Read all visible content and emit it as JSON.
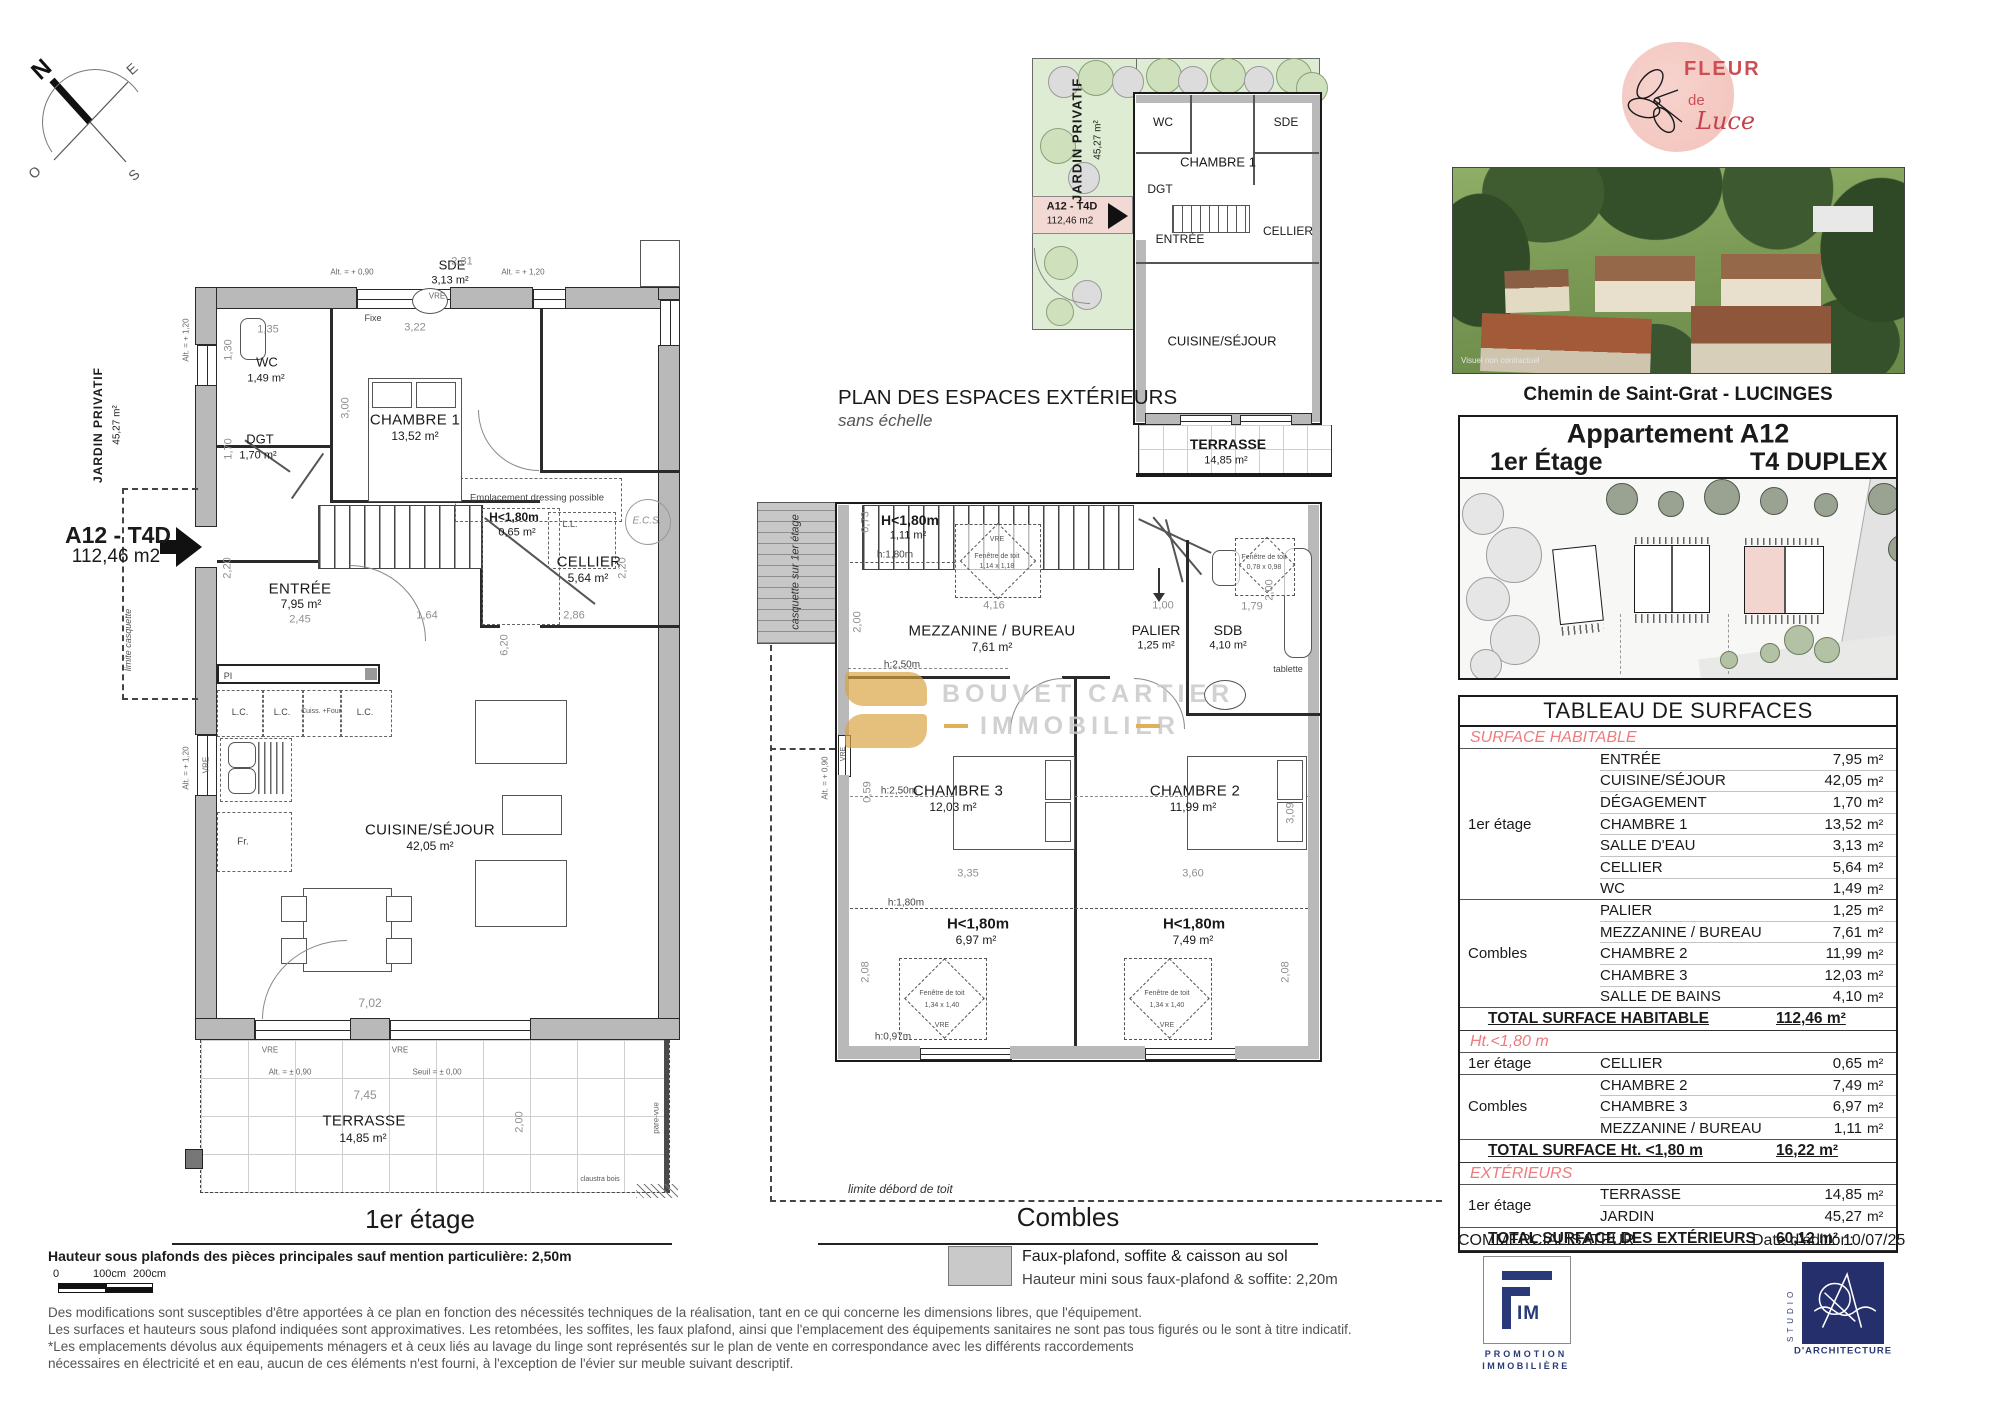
{
  "compass": {
    "n": "N",
    "e": "E",
    "s": "S",
    "o": "O"
  },
  "labels": {
    "vre": "VRE",
    "fixe": "Fixe",
    "ll": "L.L.",
    "lc": "L.C.",
    "cuiss": "Cuiss. +Four",
    "fr": "Fr.",
    "pi": "PI",
    "ecs": "E.C.S.",
    "alt_p090": "Alt. = + 0,90",
    "alt_p120": "Alt. = + 1,20",
    "alt_pm090": "Alt. = ± 0,90",
    "seuil": "Seuil = ± 0,00",
    "pare_vue": "pare-vue",
    "claustra": "claustra bois",
    "fenetre": "Fenêtre de toit"
  },
  "plan1": {
    "title": "1er étage",
    "jardin": {
      "name": "JARDIN PRIVATIF",
      "area": "45,27 m²"
    },
    "unit": {
      "code": "A12 - T4D",
      "area": "112,46 m2"
    },
    "limite_casquette": "limite casquette",
    "notes": {
      "dressing": "Emplacement dressing possible"
    },
    "rooms": {
      "wc": {
        "name": "WC",
        "area": "1,49 m²"
      },
      "dgt": {
        "name": "DGT",
        "area": "1,70 m²"
      },
      "ch1": {
        "name": "CHAMBRE 1",
        "area": "13,52 m²"
      },
      "sde": {
        "name": "SDE",
        "area": "3,13 m²"
      },
      "cellier": {
        "name": "CELLIER",
        "area": "5,64 m²"
      },
      "h180": {
        "name": "H<1,80m",
        "area": "0,65 m²"
      },
      "entree": {
        "name": "ENTRÉE",
        "area": "7,95 m²"
      },
      "cuisine": {
        "name": "CUISINE/SÉJOUR",
        "area": "42,05 m²"
      },
      "terrasse": {
        "name": "TERRASSE",
        "area": "14,85 m²"
      }
    },
    "dims": {
      "w_wc": "1,35",
      "w_ch1": "3,22",
      "w_sde": "2,31",
      "h_wc": "1,30",
      "h_ch1": "3,00",
      "h_dgt": "1,70",
      "h_porch": "2,20",
      "h_cellier": "2,20",
      "w_entree": "2,45",
      "w_stair": "1,64",
      "w_cellier": "2,86",
      "h_sejour": "6,20",
      "w_sejour": "7,02",
      "w_terr": "7,45",
      "h_terr": "2,00"
    }
  },
  "planext": {
    "title": "PLAN DES ESPACES EXTÉRIEURS",
    "subtitle": "sans échelle",
    "jardin": {
      "name": "JARDIN PRIVATIF",
      "area": "45,27 m²"
    },
    "unit": {
      "code": "A12 - T4D",
      "area": "112,46 m2"
    },
    "rooms": {
      "wc": "WC",
      "dgt": "DGT",
      "ch1": "CHAMBRE 1",
      "sde": "SDE",
      "entree": "ENTRÉE",
      "cellier": "CELLIER",
      "cuisine": "CUISINE/SÉJOUR",
      "terrasse": "TERRASSE",
      "terrasse_area": "14,85 m²"
    }
  },
  "plan2": {
    "title": "Combles",
    "casquette": "casquette sur 1er étage",
    "limite": "limite débord de toit",
    "tablette": "tablette",
    "rooms": {
      "h180a": {
        "name": "H<1,80m",
        "area": "1,11 m²"
      },
      "mezz": {
        "name": "MEZZANINE / BUREAU",
        "area": "7,61 m²"
      },
      "palier": {
        "name": "PALIER",
        "area": "1,25 m²"
      },
      "sdb": {
        "name": "SDB",
        "area": "4,10 m²"
      },
      "ch3": {
        "name": "CHAMBRE 3",
        "area": "12,03 m²"
      },
      "ch2": {
        "name": "CHAMBRE 2",
        "area": "11,99 m²"
      },
      "h180b": {
        "name": "H<1,80m",
        "area": "6,97 m²"
      },
      "h180c": {
        "name": "H<1,80m",
        "area": "7,49 m²"
      }
    },
    "heights": {
      "h180": "h:1,80m",
      "h250": "h:2,50m",
      "h097": "h:0,97m"
    },
    "windows": {
      "w1": "1,14 x 1,18",
      "w2": "0,78 x 0,98",
      "w3": "1,34 x 1,40"
    },
    "dims": {
      "d073": "0,73",
      "d416": "4,16",
      "d100": "1,00",
      "d179": "1,79",
      "d200": "2,00",
      "d335": "3,35",
      "d360": "3,60",
      "d309": "3,09",
      "d208": "2,08",
      "d059": "0,59"
    },
    "legend": {
      "line1": "Faux-plafond, soffite & caisson au sol",
      "line2": "Hauteur mini sous faux-plafond & soffite: 2,20m"
    }
  },
  "watermark": {
    "line1": "BOUVET CARTIER",
    "line2": "IMMOBILIER"
  },
  "brand": {
    "logo": {
      "word1": "FLEUR",
      "word2": "de",
      "word3": "Luce"
    },
    "photo_caption": "Visuel non contractuel",
    "address": "Chemin de Saint-Grat - LUCINGES"
  },
  "header": {
    "apartment": "Appartement A12",
    "floor": "1er Étage",
    "type": "T4 DUPLEX"
  },
  "table": {
    "title": "TABLEAU DE SURFACES",
    "unit": "m²",
    "sections": [
      {
        "label": "SURFACE HABITABLE",
        "groups": [
          {
            "label": "1er étage",
            "rows": [
              [
                "ENTRÉE",
                "7,95"
              ],
              [
                "CUISINE/SÉJOUR",
                "42,05"
              ],
              [
                "DÉGAGEMENT",
                "1,70"
              ],
              [
                "CHAMBRE 1",
                "13,52"
              ],
              [
                "SALLE D'EAU",
                "3,13"
              ],
              [
                "CELLIER",
                "5,64"
              ],
              [
                "WC",
                "1,49"
              ]
            ]
          },
          {
            "label": "Combles",
            "rows": [
              [
                "PALIER",
                "1,25"
              ],
              [
                "MEZZANINE / BUREAU",
                "7,61"
              ],
              [
                "CHAMBRE 2",
                "11,99"
              ],
              [
                "CHAMBRE 3",
                "12,03"
              ],
              [
                "SALLE DE BAINS",
                "4,10"
              ]
            ]
          }
        ],
        "total": {
          "label": "TOTAL SURFACE HABITABLE",
          "value": "112,46 m²"
        }
      },
      {
        "label": "Ht.<1,80 m",
        "groups": [
          {
            "label": "1er étage",
            "rows": [
              [
                "CELLIER",
                "0,65"
              ]
            ]
          },
          {
            "label": "Combles",
            "rows": [
              [
                "CHAMBRE 2",
                "7,49"
              ],
              [
                "CHAMBRE 3",
                "6,97"
              ],
              [
                "MEZZANINE / BUREAU",
                "1,11"
              ]
            ]
          }
        ],
        "total": {
          "label": "TOTAL SURFACE Ht. <1,80 m",
          "value": "16,22 m²"
        }
      },
      {
        "label": "EXTÉRIEURS",
        "groups": [
          {
            "label": "1er étage",
            "rows": [
              [
                "TERRASSE",
                "14,85"
              ],
              [
                "JARDIN",
                "45,27"
              ]
            ]
          }
        ],
        "total": {
          "label": "TOTAL SURFACE DES EXTÉRIEURS",
          "value": "60,12 m²"
        }
      }
    ]
  },
  "footer": {
    "commercialisateur": "COMMERCIALISATEUR",
    "date_label": "Date d'édition:",
    "date_value": "10/07/25",
    "fim": {
      "im": "IM",
      "sub1": "PROMOTION",
      "sub2": "IMMOBILIÈRE"
    },
    "studio": {
      "vertical": "STUDIO",
      "caption": "D'ARCHITECTURE"
    }
  },
  "notes": {
    "ceiling": "Hauteur sous plafonds des pièces principales sauf mention particulière: 2,50m",
    "l1": "Des modifications sont susceptibles d'être apportées à ce plan en fonction des nécessités techniques de la réalisation, tant en ce qui concerne les dimensions libres, que l'équipement.",
    "l2": "Les surfaces et hauteurs sous plafond indiquées sont approximatives. Les retombées, les soffites, les faux plafond, ainsi que l'emplacement des équipements sanitaires ne sont pas tous figurés ou le sont à titre indicatif.",
    "l3": "*Les emplacements dévolus aux équipements ménagers et à ceux liés au lavage du linge sont représentés sur le plan de vente en correspondance avec les différents raccordements",
    "l4": "nécessaires en électricité et en eau, aucun de ces éléments n'est fourni, à l'exception de l'évier sur meuble suivant descriptif."
  },
  "scalebar": {
    "z": "0",
    "c100": "100cm",
    "c200": "200cm"
  }
}
